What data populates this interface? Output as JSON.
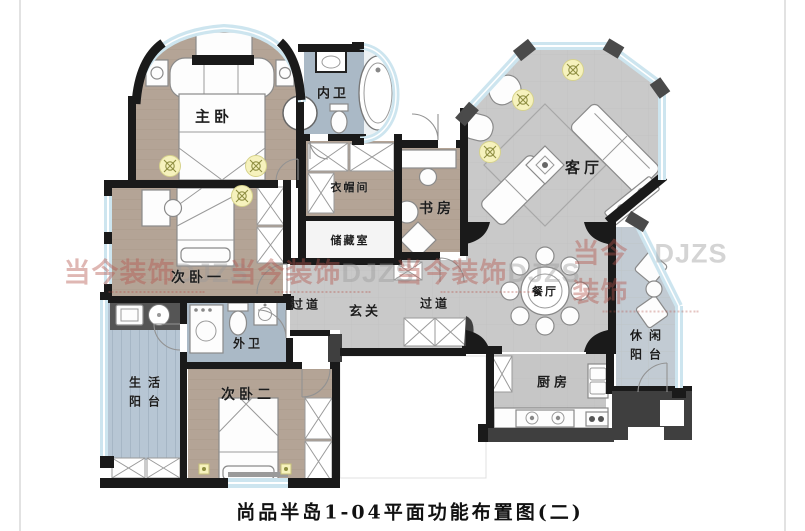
{
  "caption": "尚品半岛1-04平面功能布置图(二)",
  "watermark": {
    "brand_cn": "当今装饰",
    "brand_en": "DJZS"
  },
  "rooms": [
    {
      "id": "master-bedroom",
      "label": "主卧"
    },
    {
      "id": "inner-bathroom",
      "label": "内卫"
    },
    {
      "id": "walk-in-closet",
      "label": "衣帽间"
    },
    {
      "id": "storage-room",
      "label": "储藏室"
    },
    {
      "id": "study",
      "label": "书房"
    },
    {
      "id": "living-room",
      "label": "客厅"
    },
    {
      "id": "dining-room",
      "label": "餐厅"
    },
    {
      "id": "corridor-left",
      "label": "过道"
    },
    {
      "id": "foyer",
      "label": "玄关"
    },
    {
      "id": "corridor-right",
      "label": "过道"
    },
    {
      "id": "second-bedroom-1",
      "label": "次卧一"
    },
    {
      "id": "outer-bathroom",
      "label": "外卫"
    },
    {
      "id": "utility-balcony",
      "label": "生活阳台"
    },
    {
      "id": "second-bedroom-2",
      "label": "次卧二"
    },
    {
      "id": "kitchen",
      "label": "厨房"
    },
    {
      "id": "leisure-balcony",
      "label": "休闲阳台"
    }
  ],
  "colors": {
    "wall": "#1a1a1a",
    "bedroom_floor": "#b4a496",
    "hall_floor": "#c9c9c9",
    "bath_floor": "#aab9c6",
    "balcony_floor": "#b7c6d4",
    "window_glass": "#cde5ef",
    "lamp_yellow": "#f6f2bd",
    "watermark_red": "#b4554d"
  }
}
